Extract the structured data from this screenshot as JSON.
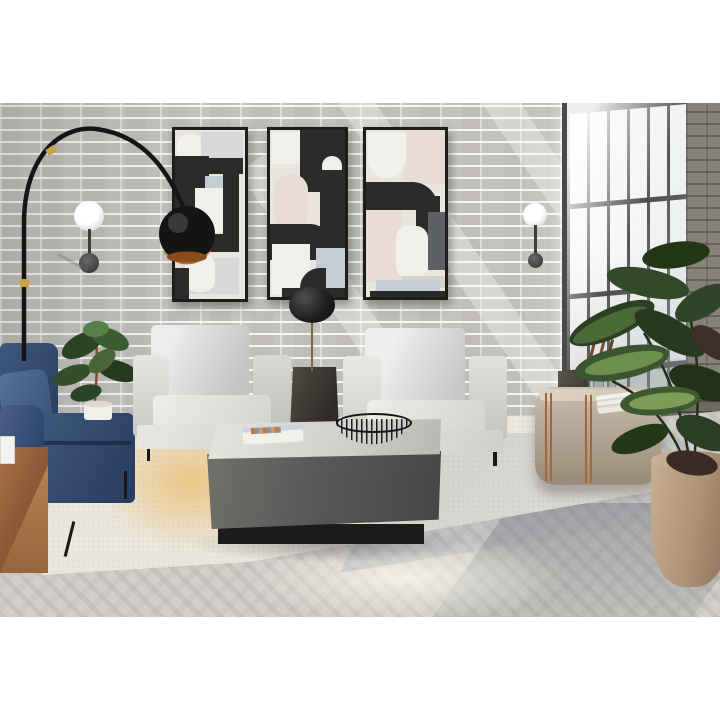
{
  "scene": {
    "type": "interior-photograph",
    "description": "Bright loft living room with whitewashed brick wall, abstract geometric triptych wall art, black arc floor lamp, two light grey armchairs, navy blue sofa, charcoal square coffee table with wire bowl and magazine, taupe media console with brass trim, tall black-framed window and large potted plants on a cream rug over herringbone wood floor",
    "text_content": "none — image contains no rendered text",
    "palette": {
      "background_white": "#ffffff",
      "brick_wall": "#c7c5c0",
      "brick_mortar": "#f3f2ef",
      "dark_brick_pillar": "#87827a",
      "window_frame": "#4a4a48",
      "window_glass": "#f2f4f5",
      "art_black": "#2b2b2a",
      "art_cream": "#e9e6e0",
      "art_pink": "#e9dcd6",
      "art_bluegray": "#c3cdd6",
      "lamp_black": "#1c1c1c",
      "lamp_copper": "#bd6f2d",
      "lamp_brass": "#c9a24a",
      "armchair_gray": "#dddcd9",
      "sofa_navy": "#344b6f",
      "coffee_table_charcoal": "#5b5b59",
      "console_taupe": "#b4a694",
      "console_brass": "#a5673a",
      "wood_cube": "#8a5634",
      "plant_green": "#2f4527",
      "plant_pot_clay": "#b39a80",
      "rug_cream": "#ece7dd",
      "sunlight_warm": "#ebba68",
      "floor_wood": "#d2cfca"
    },
    "objects": [
      {
        "name": "brick-wall",
        "color": "#c7c5c0"
      },
      {
        "name": "arc-floor-lamp",
        "color": "#1c1c1c",
        "accent": "#c9a24a"
      },
      {
        "name": "wall-sconce-left",
        "color": "#ffffff"
      },
      {
        "name": "wall-sconce-right",
        "color": "#ffffff"
      },
      {
        "name": "wall-art-panel-left",
        "style": "abstract geometric"
      },
      {
        "name": "wall-art-panel-center",
        "style": "abstract geometric"
      },
      {
        "name": "wall-art-panel-right",
        "style": "abstract geometric"
      },
      {
        "name": "tall-window",
        "color": "#4a4a48"
      },
      {
        "name": "armchair-left",
        "color": "#dddcd9"
      },
      {
        "name": "armchair-right",
        "color": "#dddcd9"
      },
      {
        "name": "side-table-dark",
        "color": "#3a3733"
      },
      {
        "name": "table-lamp-black-sphere",
        "color": "#1e1d1c"
      },
      {
        "name": "coffee-table-square",
        "color": "#5b5b59"
      },
      {
        "name": "wire-bowl",
        "color": "#1a1a1a"
      },
      {
        "name": "magazine",
        "color": "#f0eee9"
      },
      {
        "name": "sofa-navy",
        "color": "#344b6f"
      },
      {
        "name": "wood-cube-side-table",
        "color": "#8a5634"
      },
      {
        "name": "rubber-plant-small",
        "color": "#2f4527"
      },
      {
        "name": "media-console",
        "color": "#b4a694"
      },
      {
        "name": "book-stack",
        "color": "#f0eee9"
      },
      {
        "name": "potted-plant-large",
        "color": "#2f4527",
        "pot": "#b39a80"
      },
      {
        "name": "area-rug",
        "color": "#ece7dd"
      },
      {
        "name": "herringbone-floor",
        "color": "#d2cfca"
      }
    ]
  }
}
